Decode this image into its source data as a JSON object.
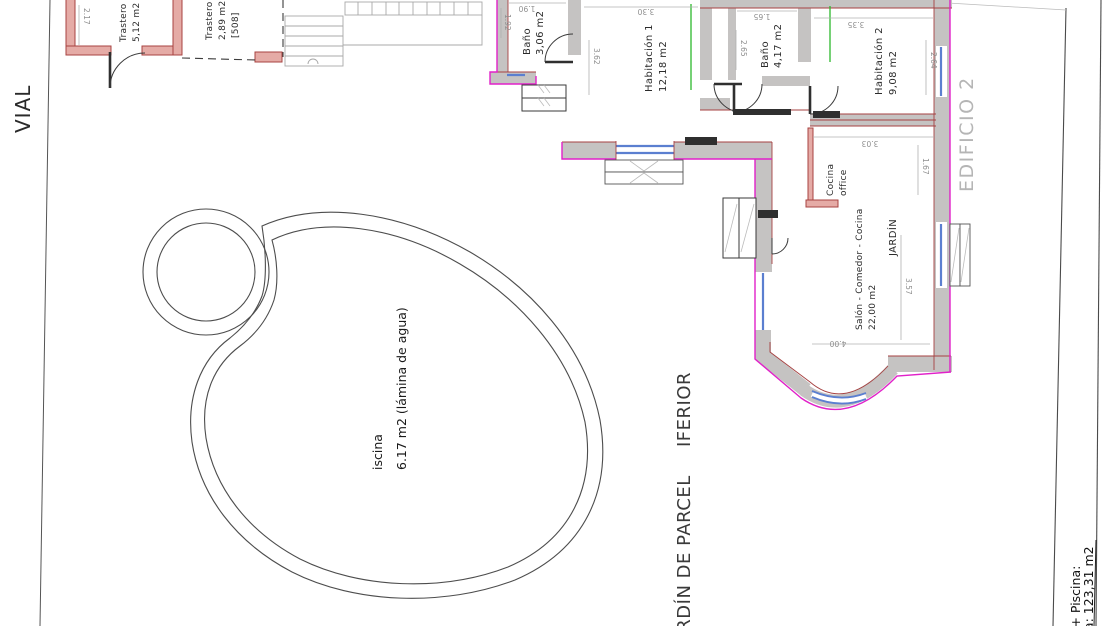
{
  "labels": {
    "vial": "VIAL",
    "edificio": "EDIFICIO 2",
    "garden_line1": "JARDÍN DE PARCEL",
    "garden_line2": "IFERIOR"
  },
  "rooms": {
    "trastero1": {
      "name": "Trastero",
      "area": "5,12 m2"
    },
    "trastero2": {
      "name": "Trastero",
      "area": "2,89 m2",
      "ref": "[508]"
    },
    "bano1": {
      "name": "Baño",
      "area": "3,06 m2"
    },
    "habitacion1": {
      "name": "Habitación 1",
      "area": "12,18 m2"
    },
    "bano2": {
      "name": "Baño",
      "area": "4,17 m2"
    },
    "habitacion2": {
      "name": "Habitación 2",
      "area": "9,08 m2"
    },
    "cocina_office": {
      "name": "Cocina",
      "name2": "office"
    },
    "jardin": {
      "name": "JARDÍN"
    },
    "salon": {
      "name": "Salón - Comedor - Cocina",
      "area": "22,00 m2"
    }
  },
  "pool": {
    "name": "iscina",
    "area": "6.17 m2 (lámina de agua)"
  },
  "dimensions": {
    "d217": "2.17",
    "d190": "1.90",
    "d192": "1.92",
    "d330": "3.30",
    "d362": "3.62",
    "d265": "2.65",
    "d165": "1.65",
    "d335": "3.35",
    "d264": "2.64",
    "d303_top": "3.03",
    "d167": "1.67",
    "d357": "3.57",
    "d400": "4.00"
  },
  "summary": {
    "line1": "s + Piscina:",
    "line2": "da: 123,31 m2"
  },
  "colors": {
    "outer_wall": "#e121c9",
    "wall_fill": "#c5c3c2",
    "inner_wall": "#a64141",
    "window": "#5b7fd0",
    "marker": "#2db82d",
    "storage_wall_fill": "#e5aba6",
    "storage_wall_stroke": "#a84341",
    "dimension": "#9a9a9a"
  }
}
